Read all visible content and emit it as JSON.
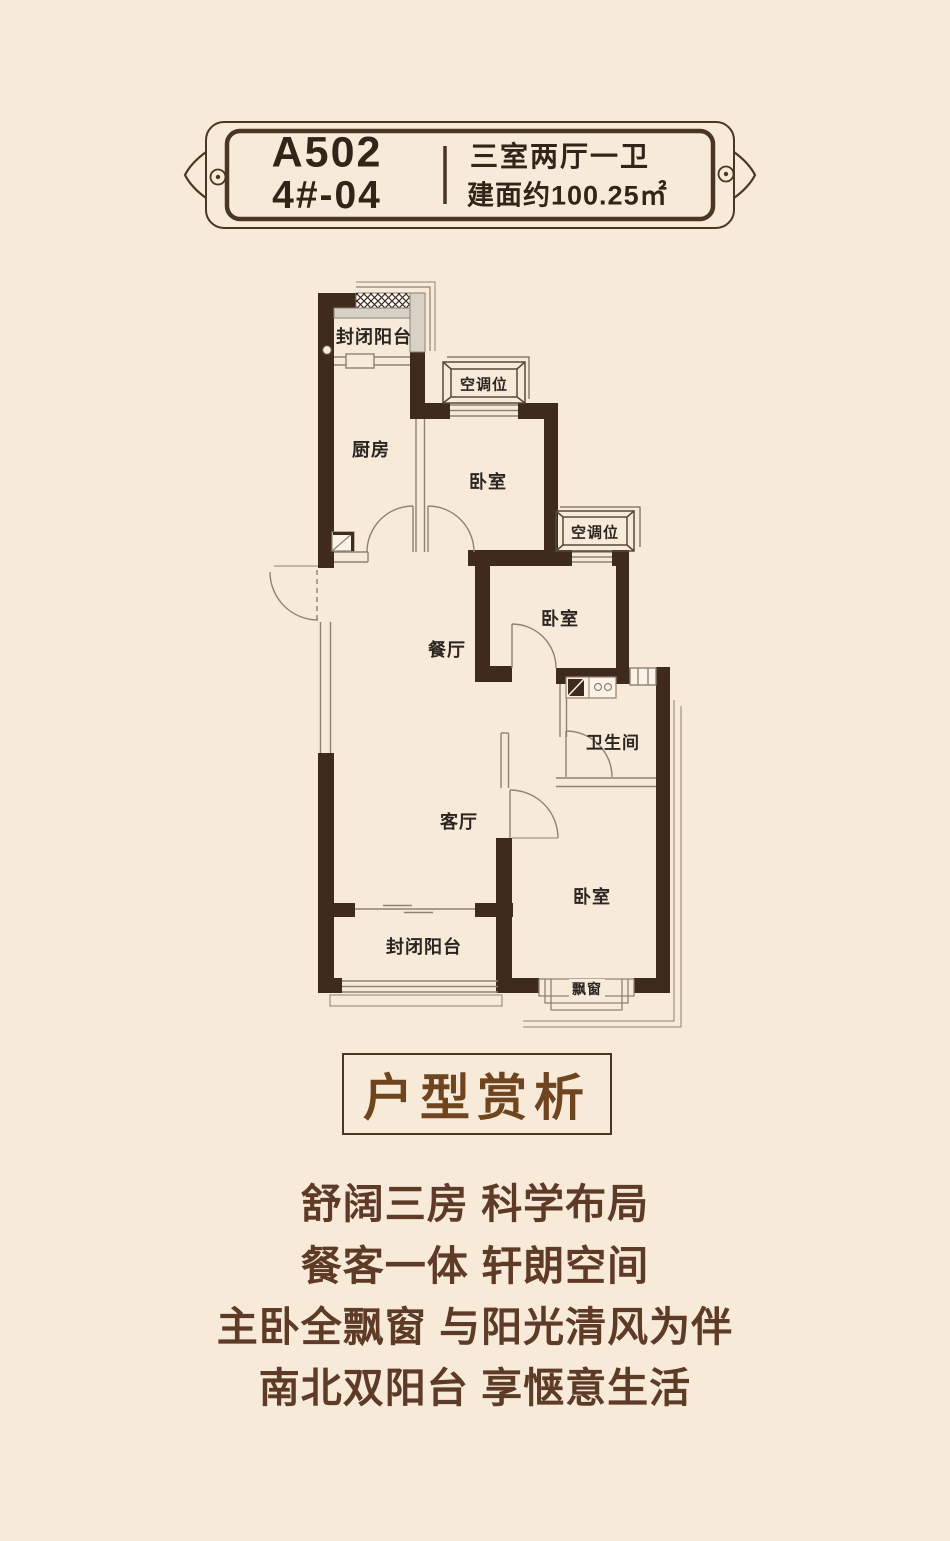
{
  "banner": {
    "unit_code": "A502",
    "unit_no": "4#-04",
    "layout_type": "三室两厅一卫",
    "area": "建面约100.25㎡"
  },
  "plan": {
    "rooms": {
      "balcony_top": "封闭阳台",
      "kitchen": "厨房",
      "ac_top": "空调位",
      "bedroom_top": "卧室",
      "ac_right": "空调位",
      "bedroom_mid": "卧室",
      "dining": "餐厅",
      "bathroom": "卫生间",
      "living": "客厅",
      "bedroom_master": "卧室",
      "balcony_bottom": "封闭阳台",
      "bay_window": "飘窗"
    }
  },
  "appreciation": {
    "title": "户型赏析",
    "lines": [
      "舒阔三房 科学布局",
      "餐客一体 轩朗空间",
      "主卧全飘窗 与阳光清风为伴",
      "南北双阳台 享惬意生活"
    ]
  },
  "colors": {
    "background": "#F8EAD9",
    "wall": "#3F2B1D",
    "thin_line": "#8C8275",
    "banner_border": "#4B3524",
    "title_brown": "#6F4520",
    "body_text": "#5D3B26",
    "label_text": "#2B2621",
    "glazing_gray": "#D8D2C6"
  }
}
